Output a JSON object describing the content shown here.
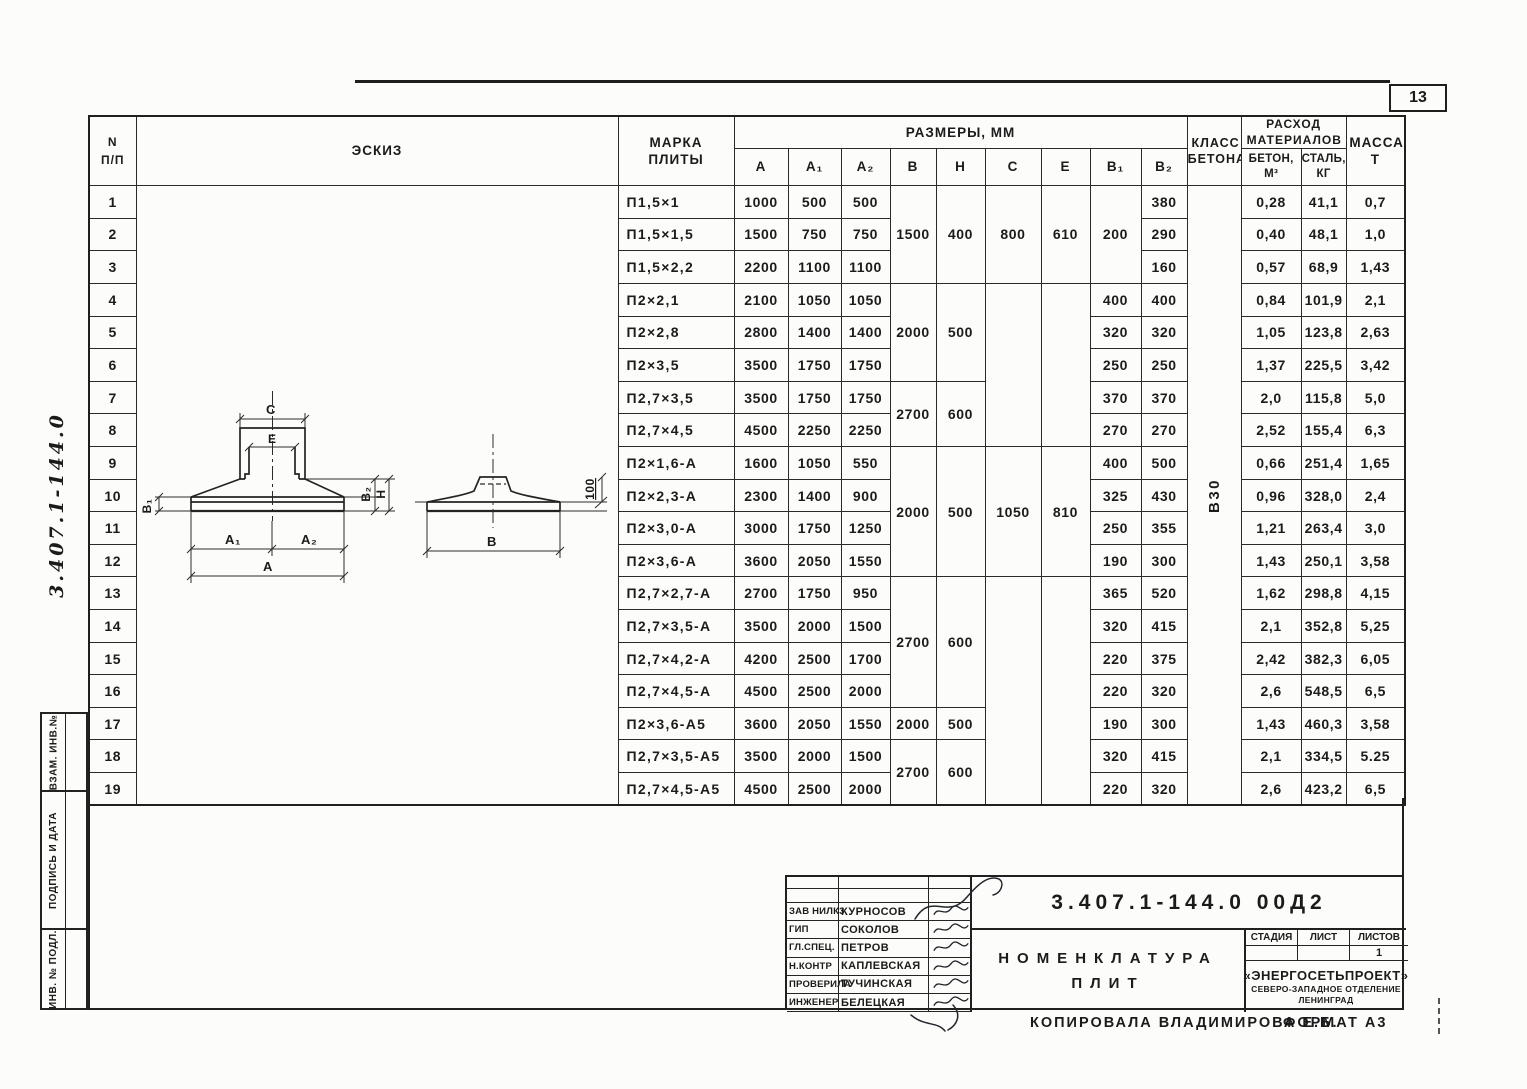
{
  "page": {
    "number": "13",
    "side_doc": "3.407.1-144.0",
    "copied_by": "Копировала Владимирова Е.Б.",
    "format": "Формат А3"
  },
  "left_margin": {
    "labels": [
      "Взам. инв.№",
      "Подпись и дата",
      "Инв. № подл."
    ]
  },
  "table": {
    "headers": {
      "no1": "N",
      "no2": "п/п",
      "sketch": "Эскиз",
      "mark": "Марка плиты",
      "dims": "Размеры, мм",
      "a": "А",
      "a1": "А₁",
      "a2": "А₂",
      "b": "В",
      "h": "Н",
      "c": "С",
      "e": "е",
      "b1": "В₁",
      "b2": "В₂",
      "concrete_class": "Класс бетона",
      "consumption": "Расход материалов",
      "concrete": "Бетон, м³",
      "steel": "Сталь, кг",
      "mass": "Масса, т"
    },
    "rows": [
      [
        {
          "t": "1"
        },
        {
          "sk": 1,
          "rs": 19
        },
        {
          "t": "П1,5×1",
          "m": 1
        },
        {
          "t": "1000"
        },
        {
          "t": "500"
        },
        {
          "t": "500"
        },
        {
          "t": "1500",
          "rs": 3
        },
        {
          "t": "400",
          "rs": 3
        },
        {
          "t": "800",
          "rs": 3
        },
        {
          "t": "610",
          "rs": 3
        },
        {
          "t": "200",
          "rs": 3
        },
        {
          "t": "380"
        },
        {
          "t": "В30",
          "rot": 1,
          "rs": 19
        },
        {
          "t": "0,28"
        },
        {
          "t": "41,1"
        },
        {
          "t": "0,7"
        }
      ],
      [
        {
          "t": "2"
        },
        {
          "t": "П1,5×1,5",
          "m": 1
        },
        {
          "t": "1500"
        },
        {
          "t": "750"
        },
        {
          "t": "750"
        },
        {
          "t": "290"
        },
        {
          "t": "0,40"
        },
        {
          "t": "48,1"
        },
        {
          "t": "1,0"
        }
      ],
      [
        {
          "t": "3"
        },
        {
          "t": "П1,5×2,2",
          "m": 1
        },
        {
          "t": "2200"
        },
        {
          "t": "1100"
        },
        {
          "t": "1100"
        },
        {
          "t": "160"
        },
        {
          "t": "0,57"
        },
        {
          "t": "68,9"
        },
        {
          "t": "1,43"
        }
      ],
      [
        {
          "t": "4"
        },
        {
          "t": "П2×2,1",
          "m": 1
        },
        {
          "t": "2100"
        },
        {
          "t": "1050"
        },
        {
          "t": "1050"
        },
        {
          "t": "2000",
          "rs": 3
        },
        {
          "t": "500",
          "rs": 3
        },
        {
          "t": "",
          "rs": 5
        },
        {
          "t": "",
          "rs": 5
        },
        {
          "t": "400"
        },
        {
          "t": "400"
        },
        {
          "t": "0,84"
        },
        {
          "t": "101,9"
        },
        {
          "t": "2,1"
        }
      ],
      [
        {
          "t": "5"
        },
        {
          "t": "П2×2,8",
          "m": 1
        },
        {
          "t": "2800"
        },
        {
          "t": "1400"
        },
        {
          "t": "1400"
        },
        {
          "t": "320"
        },
        {
          "t": "320"
        },
        {
          "t": "1,05"
        },
        {
          "t": "123,8"
        },
        {
          "t": "2,63"
        }
      ],
      [
        {
          "t": "6"
        },
        {
          "t": "П2×3,5",
          "m": 1
        },
        {
          "t": "3500"
        },
        {
          "t": "1750"
        },
        {
          "t": "1750"
        },
        {
          "t": "250"
        },
        {
          "t": "250"
        },
        {
          "t": "1,37"
        },
        {
          "t": "225,5"
        },
        {
          "t": "3,42"
        }
      ],
      [
        {
          "t": "7"
        },
        {
          "t": "П2,7×3,5",
          "m": 1
        },
        {
          "t": "3500"
        },
        {
          "t": "1750"
        },
        {
          "t": "1750"
        },
        {
          "t": "2700",
          "rs": 2
        },
        {
          "t": "600",
          "rs": 2
        },
        {
          "t": "370"
        },
        {
          "t": "370"
        },
        {
          "t": "2,0"
        },
        {
          "t": "115,8"
        },
        {
          "t": "5,0"
        }
      ],
      [
        {
          "t": "8"
        },
        {
          "t": "П2,7×4,5",
          "m": 1
        },
        {
          "t": "4500"
        },
        {
          "t": "2250"
        },
        {
          "t": "2250"
        },
        {
          "t": "270"
        },
        {
          "t": "270"
        },
        {
          "t": "2,52"
        },
        {
          "t": "155,4"
        },
        {
          "t": "6,3"
        }
      ],
      [
        {
          "t": "9"
        },
        {
          "t": "П2×1,6-А",
          "m": 1
        },
        {
          "t": "1600"
        },
        {
          "t": "1050"
        },
        {
          "t": "550"
        },
        {
          "t": "2000",
          "rs": 4
        },
        {
          "t": "500",
          "rs": 4
        },
        {
          "t": "1050",
          "rs": 4
        },
        {
          "t": "810",
          "rs": 4
        },
        {
          "t": "400"
        },
        {
          "t": "500"
        },
        {
          "t": "0,66"
        },
        {
          "t": "251,4"
        },
        {
          "t": "1,65"
        }
      ],
      [
        {
          "t": "10"
        },
        {
          "t": "П2×2,3-А",
          "m": 1
        },
        {
          "t": "2300"
        },
        {
          "t": "1400"
        },
        {
          "t": "900"
        },
        {
          "t": "325"
        },
        {
          "t": "430"
        },
        {
          "t": "0,96"
        },
        {
          "t": "328,0"
        },
        {
          "t": "2,4"
        }
      ],
      [
        {
          "t": "11"
        },
        {
          "t": "П2×3,0-А",
          "m": 1
        },
        {
          "t": "3000"
        },
        {
          "t": "1750"
        },
        {
          "t": "1250"
        },
        {
          "t": "250"
        },
        {
          "t": "355"
        },
        {
          "t": "1,21"
        },
        {
          "t": "263,4"
        },
        {
          "t": "3,0"
        }
      ],
      [
        {
          "t": "12"
        },
        {
          "t": "П2×3,6-А",
          "m": 1
        },
        {
          "t": "3600"
        },
        {
          "t": "2050"
        },
        {
          "t": "1550"
        },
        {
          "t": "190"
        },
        {
          "t": "300"
        },
        {
          "t": "1,43"
        },
        {
          "t": "250,1"
        },
        {
          "t": "3,58"
        }
      ],
      [
        {
          "t": "13"
        },
        {
          "t": "П2,7×2,7-А",
          "m": 1
        },
        {
          "t": "2700"
        },
        {
          "t": "1750"
        },
        {
          "t": "950"
        },
        {
          "t": "2700",
          "rs": 4
        },
        {
          "t": "600",
          "rs": 4
        },
        {
          "t": "",
          "rs": 7
        },
        {
          "t": "",
          "rs": 7
        },
        {
          "t": "365"
        },
        {
          "t": "520"
        },
        {
          "t": "1,62"
        },
        {
          "t": "298,8"
        },
        {
          "t": "4,15"
        }
      ],
      [
        {
          "t": "14"
        },
        {
          "t": "П2,7×3,5-А",
          "m": 1
        },
        {
          "t": "3500"
        },
        {
          "t": "2000"
        },
        {
          "t": "1500"
        },
        {
          "t": "320"
        },
        {
          "t": "415"
        },
        {
          "t": "2,1"
        },
        {
          "t": "352,8"
        },
        {
          "t": "5,25"
        }
      ],
      [
        {
          "t": "15"
        },
        {
          "t": "П2,7×4,2-А",
          "m": 1
        },
        {
          "t": "4200"
        },
        {
          "t": "2500"
        },
        {
          "t": "1700"
        },
        {
          "t": "220"
        },
        {
          "t": "375"
        },
        {
          "t": "2,42"
        },
        {
          "t": "382,3"
        },
        {
          "t": "6,05"
        }
      ],
      [
        {
          "t": "16"
        },
        {
          "t": "П2,7×4,5-А",
          "m": 1
        },
        {
          "t": "4500"
        },
        {
          "t": "2500"
        },
        {
          "t": "2000"
        },
        {
          "t": "220"
        },
        {
          "t": "320"
        },
        {
          "t": "2,6"
        },
        {
          "t": "548,5"
        },
        {
          "t": "6,5"
        }
      ],
      [
        {
          "t": "17"
        },
        {
          "t": "П2×3,6-А5",
          "m": 1
        },
        {
          "t": "3600"
        },
        {
          "t": "2050"
        },
        {
          "t": "1550"
        },
        {
          "t": "2000"
        },
        {
          "t": "500"
        },
        {
          "t": "190"
        },
        {
          "t": "300"
        },
        {
          "t": "1,43"
        },
        {
          "t": "460,3"
        },
        {
          "t": "3,58"
        }
      ],
      [
        {
          "t": "18"
        },
        {
          "t": "П2,7×3,5-А5",
          "m": 1
        },
        {
          "t": "3500"
        },
        {
          "t": "2000"
        },
        {
          "t": "1500"
        },
        {
          "t": "2700",
          "rs": 2
        },
        {
          "t": "600",
          "rs": 2
        },
        {
          "t": "320"
        },
        {
          "t": "415"
        },
        {
          "t": "2,1"
        },
        {
          "t": "334,5"
        },
        {
          "t": "5.25"
        }
      ],
      [
        {
          "t": "19"
        },
        {
          "t": "П2,7×4,5-А5",
          "m": 1
        },
        {
          "t": "4500"
        },
        {
          "t": "2500"
        },
        {
          "t": "2000"
        },
        {
          "t": "220"
        },
        {
          "t": "320"
        },
        {
          "t": "2,6"
        },
        {
          "t": "423,2"
        },
        {
          "t": "6,5"
        }
      ]
    ]
  },
  "sketch": {
    "labels": {
      "c": "С",
      "e": "е",
      "b1": "В₁",
      "b2": "В₂",
      "h": "Н",
      "a1": "А₁",
      "a2": "А₂",
      "a": "А",
      "b": "В",
      "offset": "100"
    }
  },
  "title_block": {
    "doc_number": "3.407.1-144.0  00Д2",
    "title_line1": "Номенклатура",
    "title_line2": "плит",
    "signatures": [
      {
        "role": "",
        "name": ""
      },
      {
        "role": "",
        "name": ""
      },
      {
        "role": "Зав НИЛК3",
        "name": "Курносов"
      },
      {
        "role": "ГИП",
        "name": "Соколов"
      },
      {
        "role": "Гл.спец.",
        "name": "Петров"
      },
      {
        "role": "Н.контр",
        "name": "Каплевская"
      },
      {
        "role": "Проверила",
        "name": "Тучинская"
      },
      {
        "role": "Инженер",
        "name": "Белецкая"
      }
    ],
    "stage_label": "Стадия",
    "sheet_label": "Лист",
    "sheets_label": "Листов",
    "sheets_value": "1",
    "org1": "«ЭНЕРГОСЕТЬПРОЕКТ»",
    "org2": "Северо-Западное отделение",
    "org3": "Ленинград"
  }
}
